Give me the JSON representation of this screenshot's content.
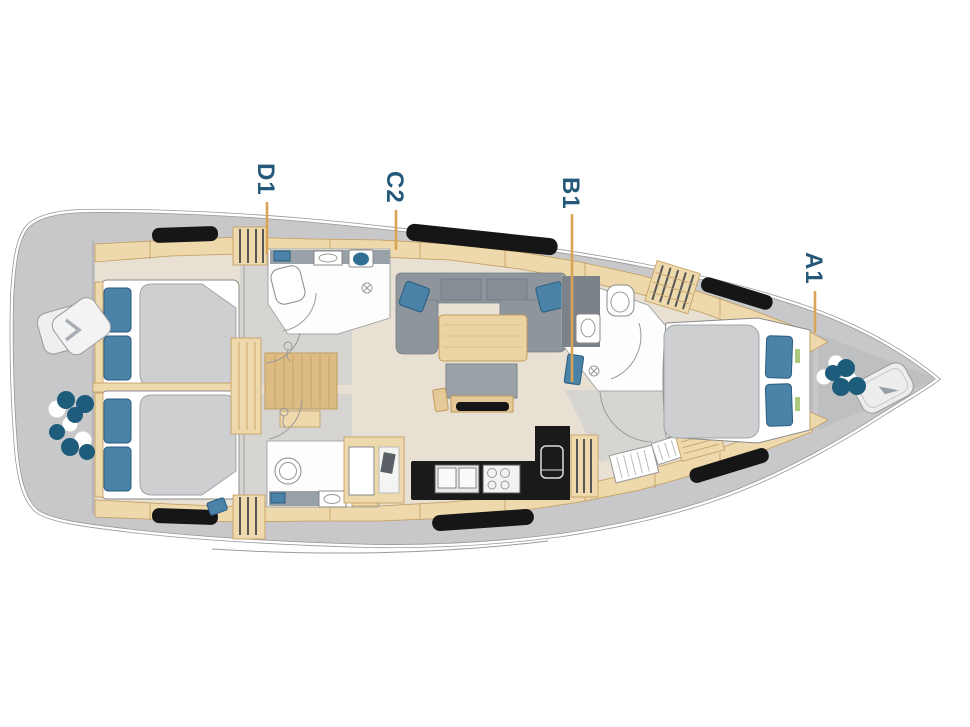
{
  "diagram": {
    "type": "yacht-deck-floorplan",
    "cabin_labels": [
      {
        "id": "d1",
        "text": "D1"
      },
      {
        "id": "c2",
        "text": "C2"
      },
      {
        "id": "b1",
        "text": "B1"
      },
      {
        "id": "a1",
        "text": "A1"
      }
    ],
    "icons": [
      "stern-winches-icon",
      "stern-seats-icon",
      "bow-winches-icon",
      "anchor-locker-icon",
      "toilet-icon",
      "sink-icon",
      "shower-seat-icon",
      "shower-drain-icon",
      "stove-icon",
      "galley-sink-icon",
      "fridge-icon",
      "tv-console-icon",
      "companionway-stairs-icon"
    ]
  },
  "colors": {
    "deck_gray": "#c8c8ca",
    "deck_dark": "#bebfc1",
    "floor_beige": "#e7e0d3",
    "floor_gray": "#d7d5d2",
    "wood": "#eed9ac",
    "wood_dark": "#c29c5e",
    "wood_stairs": "#dcbc83",
    "duvet_gray": "#cdcfd1",
    "sofa_gray": "#8e959d",
    "sofa_dark": "#767d85",
    "counter_gray": "#98a0a8",
    "cabinet_dark": "#7b828a",
    "pillow_blue": "#4a82a8",
    "pillow_border": "#2a5c80",
    "winch_teal": "#1e5c7b",
    "accent_orange": "#d9a455",
    "label_teal": "#25597a",
    "appliance_black": "#1a1a1a",
    "hull_outline": "#98989a",
    "room_stroke": "#a8a8a8",
    "window_black": "#161616",
    "accent_green": "#aec87e"
  }
}
